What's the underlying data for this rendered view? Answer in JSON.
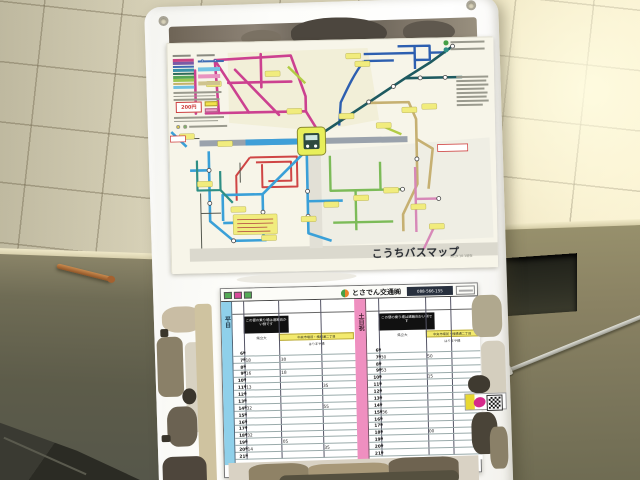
{
  "scene_type": "photo of bus-stop sign board on concrete block wall",
  "sign": {
    "map_poster": {
      "title": "こうちバスマップ",
      "revision_note": "2019.10.1現在",
      "fare_badge": "200円",
      "legend_colors": [
        "#c84383",
        "#7a5ba5",
        "#3f6cb3",
        "#3a93a8",
        "#2e6b58",
        "#55a556",
        "#9cc653",
        "#c5b26a",
        "#6fc0e2"
      ],
      "route_colors": {
        "magenta": "#cc4190",
        "red": "#cf4545",
        "blue": "#2d5fb0",
        "dark_teal": "#1e5a60",
        "tan": "#c6b072",
        "light_blue": "#3aa0d8",
        "teal": "#2f8f85",
        "green": "#7cbb58",
        "pink": "#d788b8",
        "yellow_green": "#b2cc45",
        "terminal_yellow": "#e8ef5a",
        "label_yellow": "#f1ec7d"
      }
    },
    "timetable": {
      "operator": "とさでん交通㈱",
      "phone": "088-566-155",
      "header_chip_colors": [
        "#55aa55",
        "#d84a9a",
        "#55aa55"
      ],
      "hours": [
        "6",
        "7",
        "8",
        "9",
        "10",
        "11",
        "12",
        "13",
        "14",
        "15",
        "16",
        "17",
        "18",
        "19",
        "20",
        "21"
      ],
      "hour_suffix": "時",
      "panels": [
        {
          "day_label": "平日",
          "day_color": "#8fd0ea",
          "columns": [
            {
              "label": "医療センター",
              "tag": "#55aa55"
            },
            {
              "label": "県庁前",
              "tag": "#d84a9a"
            },
            {
              "label": "桟橋車庫",
              "tag": "#55aa55"
            }
          ],
          "notice": "この便の乗り場は道路向かい側です",
          "via_left": "県立大",
          "via_highlight": "中央市場前・棧橋通二丁目",
          "via_sub": "はりまや橋",
          "rows": [
            [
              "",
              "",
              ""
            ],
            [
              "18",
              "30",
              ""
            ],
            [
              "",
              "",
              ""
            ],
            [
              "16",
              "18",
              ""
            ],
            [
              "",
              "",
              ""
            ],
            [
              "13",
              "",
              "35"
            ],
            [
              "",
              "",
              ""
            ],
            [
              "",
              "",
              ""
            ],
            [
              "32",
              "",
              "55"
            ],
            [
              "",
              "",
              ""
            ],
            [
              "",
              "",
              ""
            ],
            [
              "",
              "",
              ""
            ],
            [
              "32",
              "",
              ""
            ],
            [
              "",
              "05",
              ""
            ],
            [
              "14",
              "",
              "35"
            ],
            [
              "",
              "",
              ""
            ]
          ]
        },
        {
          "day_label": "土日祝",
          "day_color": "#ef8fc0",
          "columns": [
            {
              "label": "医療センター",
              "tag": "#55aa55"
            },
            {
              "label": "",
              "tag": ""
            },
            {
              "label": "桟橋車庫",
              "tag": "#55aa55"
            }
          ],
          "notice": "この便の乗り場は道路向かい側です",
          "via_left": "県立大",
          "via_highlight": "中央市場前・棧橋通二丁目",
          "via_sub": "はりまや橋",
          "rows": [
            [
              "",
              "",
              ""
            ],
            [
              "30",
              "50",
              ""
            ],
            [
              "",
              "",
              ""
            ],
            [
              "53",
              "",
              ""
            ],
            [
              "",
              "15",
              ""
            ],
            [
              "",
              "",
              ""
            ],
            [
              "",
              "",
              ""
            ],
            [
              "",
              "",
              ""
            ],
            [
              "",
              "",
              ""
            ],
            [
              "36",
              "",
              ""
            ],
            [
              "",
              "",
              ""
            ],
            [
              "",
              "",
              ""
            ],
            [
              "",
              "00",
              ""
            ],
            [
              "",
              "",
              ""
            ],
            [
              "",
              "",
              ""
            ],
            [
              "",
              "",
              ""
            ]
          ]
        }
      ]
    }
  }
}
